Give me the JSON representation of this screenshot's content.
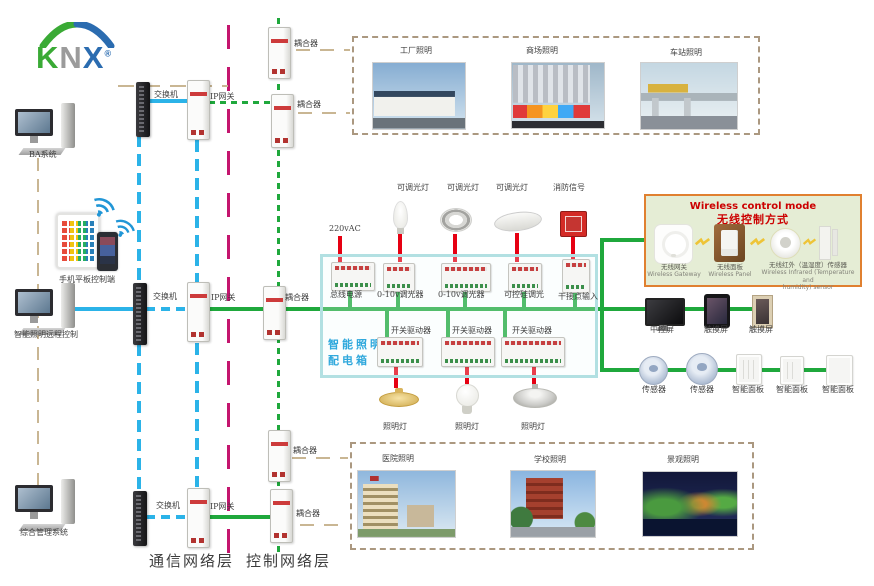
{
  "logo": {
    "k": "K",
    "n": "N",
    "x": "X",
    "reg": "®"
  },
  "left_column": {
    "ba_system": "BA系统",
    "mobile_control": "手机平板控制端",
    "remote_control": "智能照明远程控制",
    "management_system": "综合管理系统"
  },
  "network": {
    "switch": "交换机",
    "ip_gateway": "IP网关",
    "coupler": "耦合器"
  },
  "layers": {
    "communication": "通信网络层",
    "control": "控制网络层"
  },
  "applications": {
    "top": [
      "工厂照明",
      "商场照明",
      "车站照明"
    ],
    "bottom": [
      "医院照明",
      "学校照明",
      "景观照明"
    ]
  },
  "distribution_box": {
    "title_line1": "智能照明",
    "title_line2": "配电箱",
    "power": "220vAC",
    "row1": [
      "总线电源",
      "0-10v调光器",
      "0-10v调光器",
      "可控硅调光",
      "干接点输入"
    ],
    "row2": [
      "开关驱动器",
      "开关驱动器",
      "开关驱动器"
    ],
    "lamp_top": [
      "可调光灯",
      "可调光灯",
      "可调光灯",
      "消防信号"
    ],
    "lamp_bottom": [
      "照明灯",
      "照明灯",
      "照明灯"
    ]
  },
  "wireless": {
    "title_en": "Wireless control mode",
    "title_cn": "无线控制方式",
    "gateway_cn": "无线网关",
    "gateway_en": "Wireless Gateway",
    "panel_cn": "无线面板",
    "panel_en": "Wireless Panel",
    "sensor_cn": "无线红外（温湿度）传感器",
    "sensor_en_line1": "Wireless Infrared (Temperature and",
    "sensor_en_line2": "humidity) sensor"
  },
  "right_column": {
    "screens": [
      "中控屏",
      "触摸屏",
      "触摸屏"
    ],
    "sensors": [
      "传感器",
      "传感器"
    ],
    "smart_panels": [
      "智能面板",
      "智能面板",
      "智能面板"
    ]
  },
  "colors": {
    "ethernet": "#2bb3e8",
    "knx_bus": "#1fa83c",
    "power": "#e60012",
    "layer_divider": "#c4156e",
    "app_link": "#c9b693",
    "box_border": "#b2e0e2",
    "box_title": "#2fa8dc",
    "wireless_border": "#e08030",
    "wireless_bg": "#e5edd5",
    "wireless_title": "#cc0000",
    "knx_green": "#3aaa35",
    "knx_gray": "#9b9b9b",
    "knx_blue": "#2b6cb0"
  }
}
